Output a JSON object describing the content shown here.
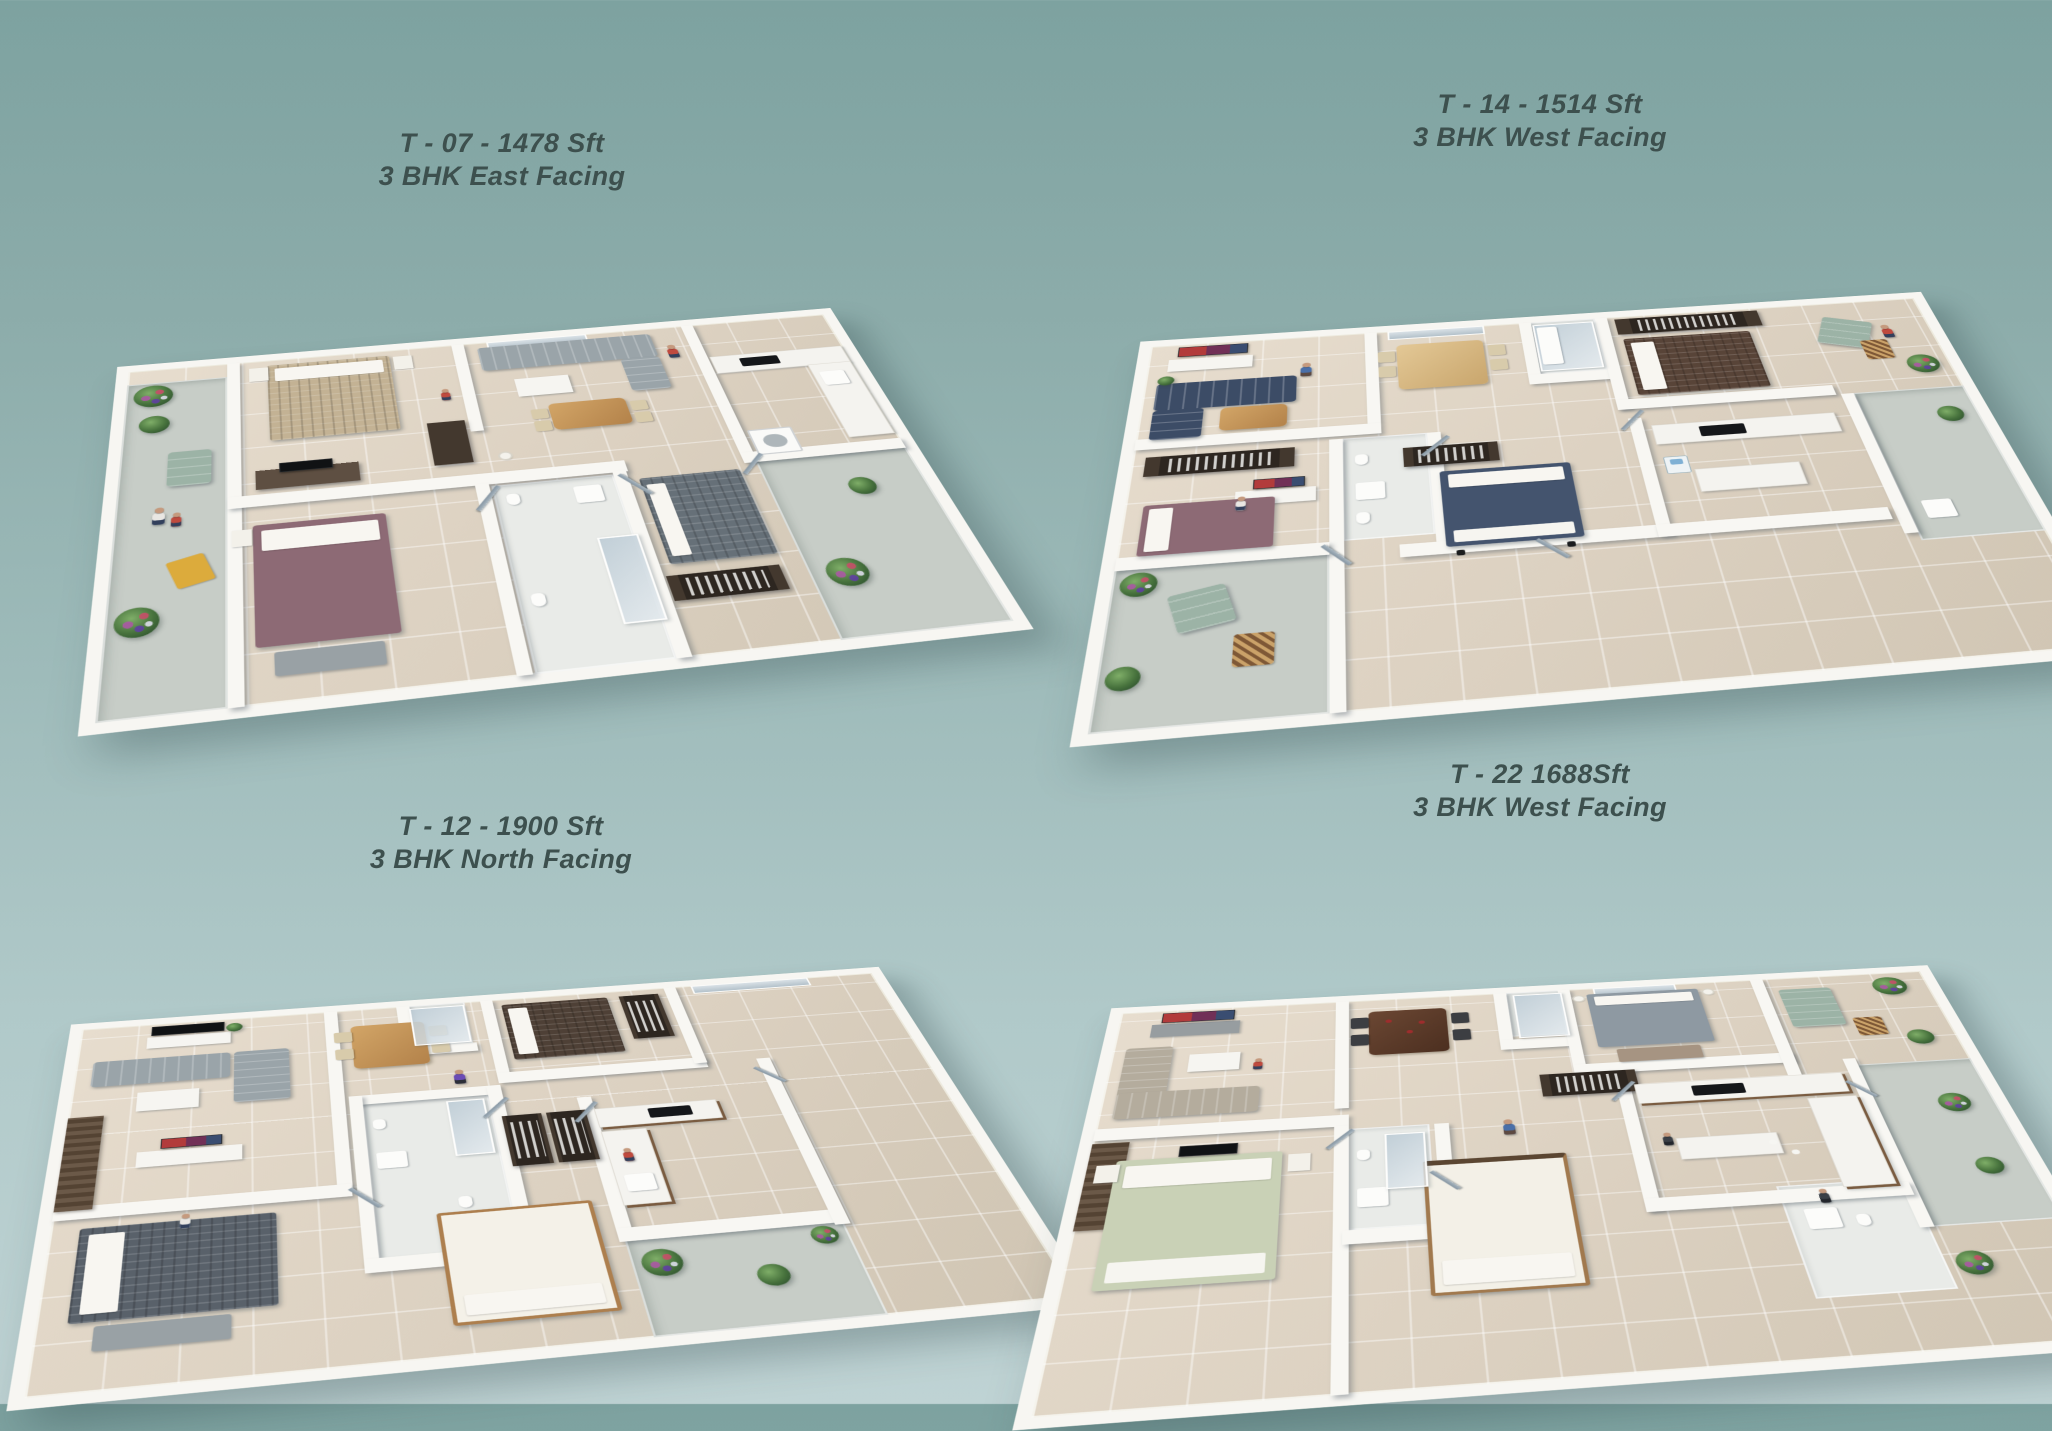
{
  "page": {
    "background_top": "#7da2a0",
    "background_bottom": "#bfd3d4",
    "label_color": "#3d504e",
    "floor_color": "#dcd1c1",
    "wall_color": "#f7f6f2"
  },
  "plans": [
    {
      "id": "t-07",
      "title": "T - 07 - 1478 Sft",
      "subtitle": "3 BHK East Facing"
    },
    {
      "id": "t-14",
      "title": "T - 14 - 1514 Sft",
      "subtitle": "3 BHK West Facing"
    },
    {
      "id": "t-12",
      "title": "T - 12 - 1900 Sft",
      "subtitle": "3 BHK North Facing"
    },
    {
      "id": "t-22",
      "title": "T - 22 1688Sft",
      "subtitle": "3 BHK West Facing"
    }
  ]
}
